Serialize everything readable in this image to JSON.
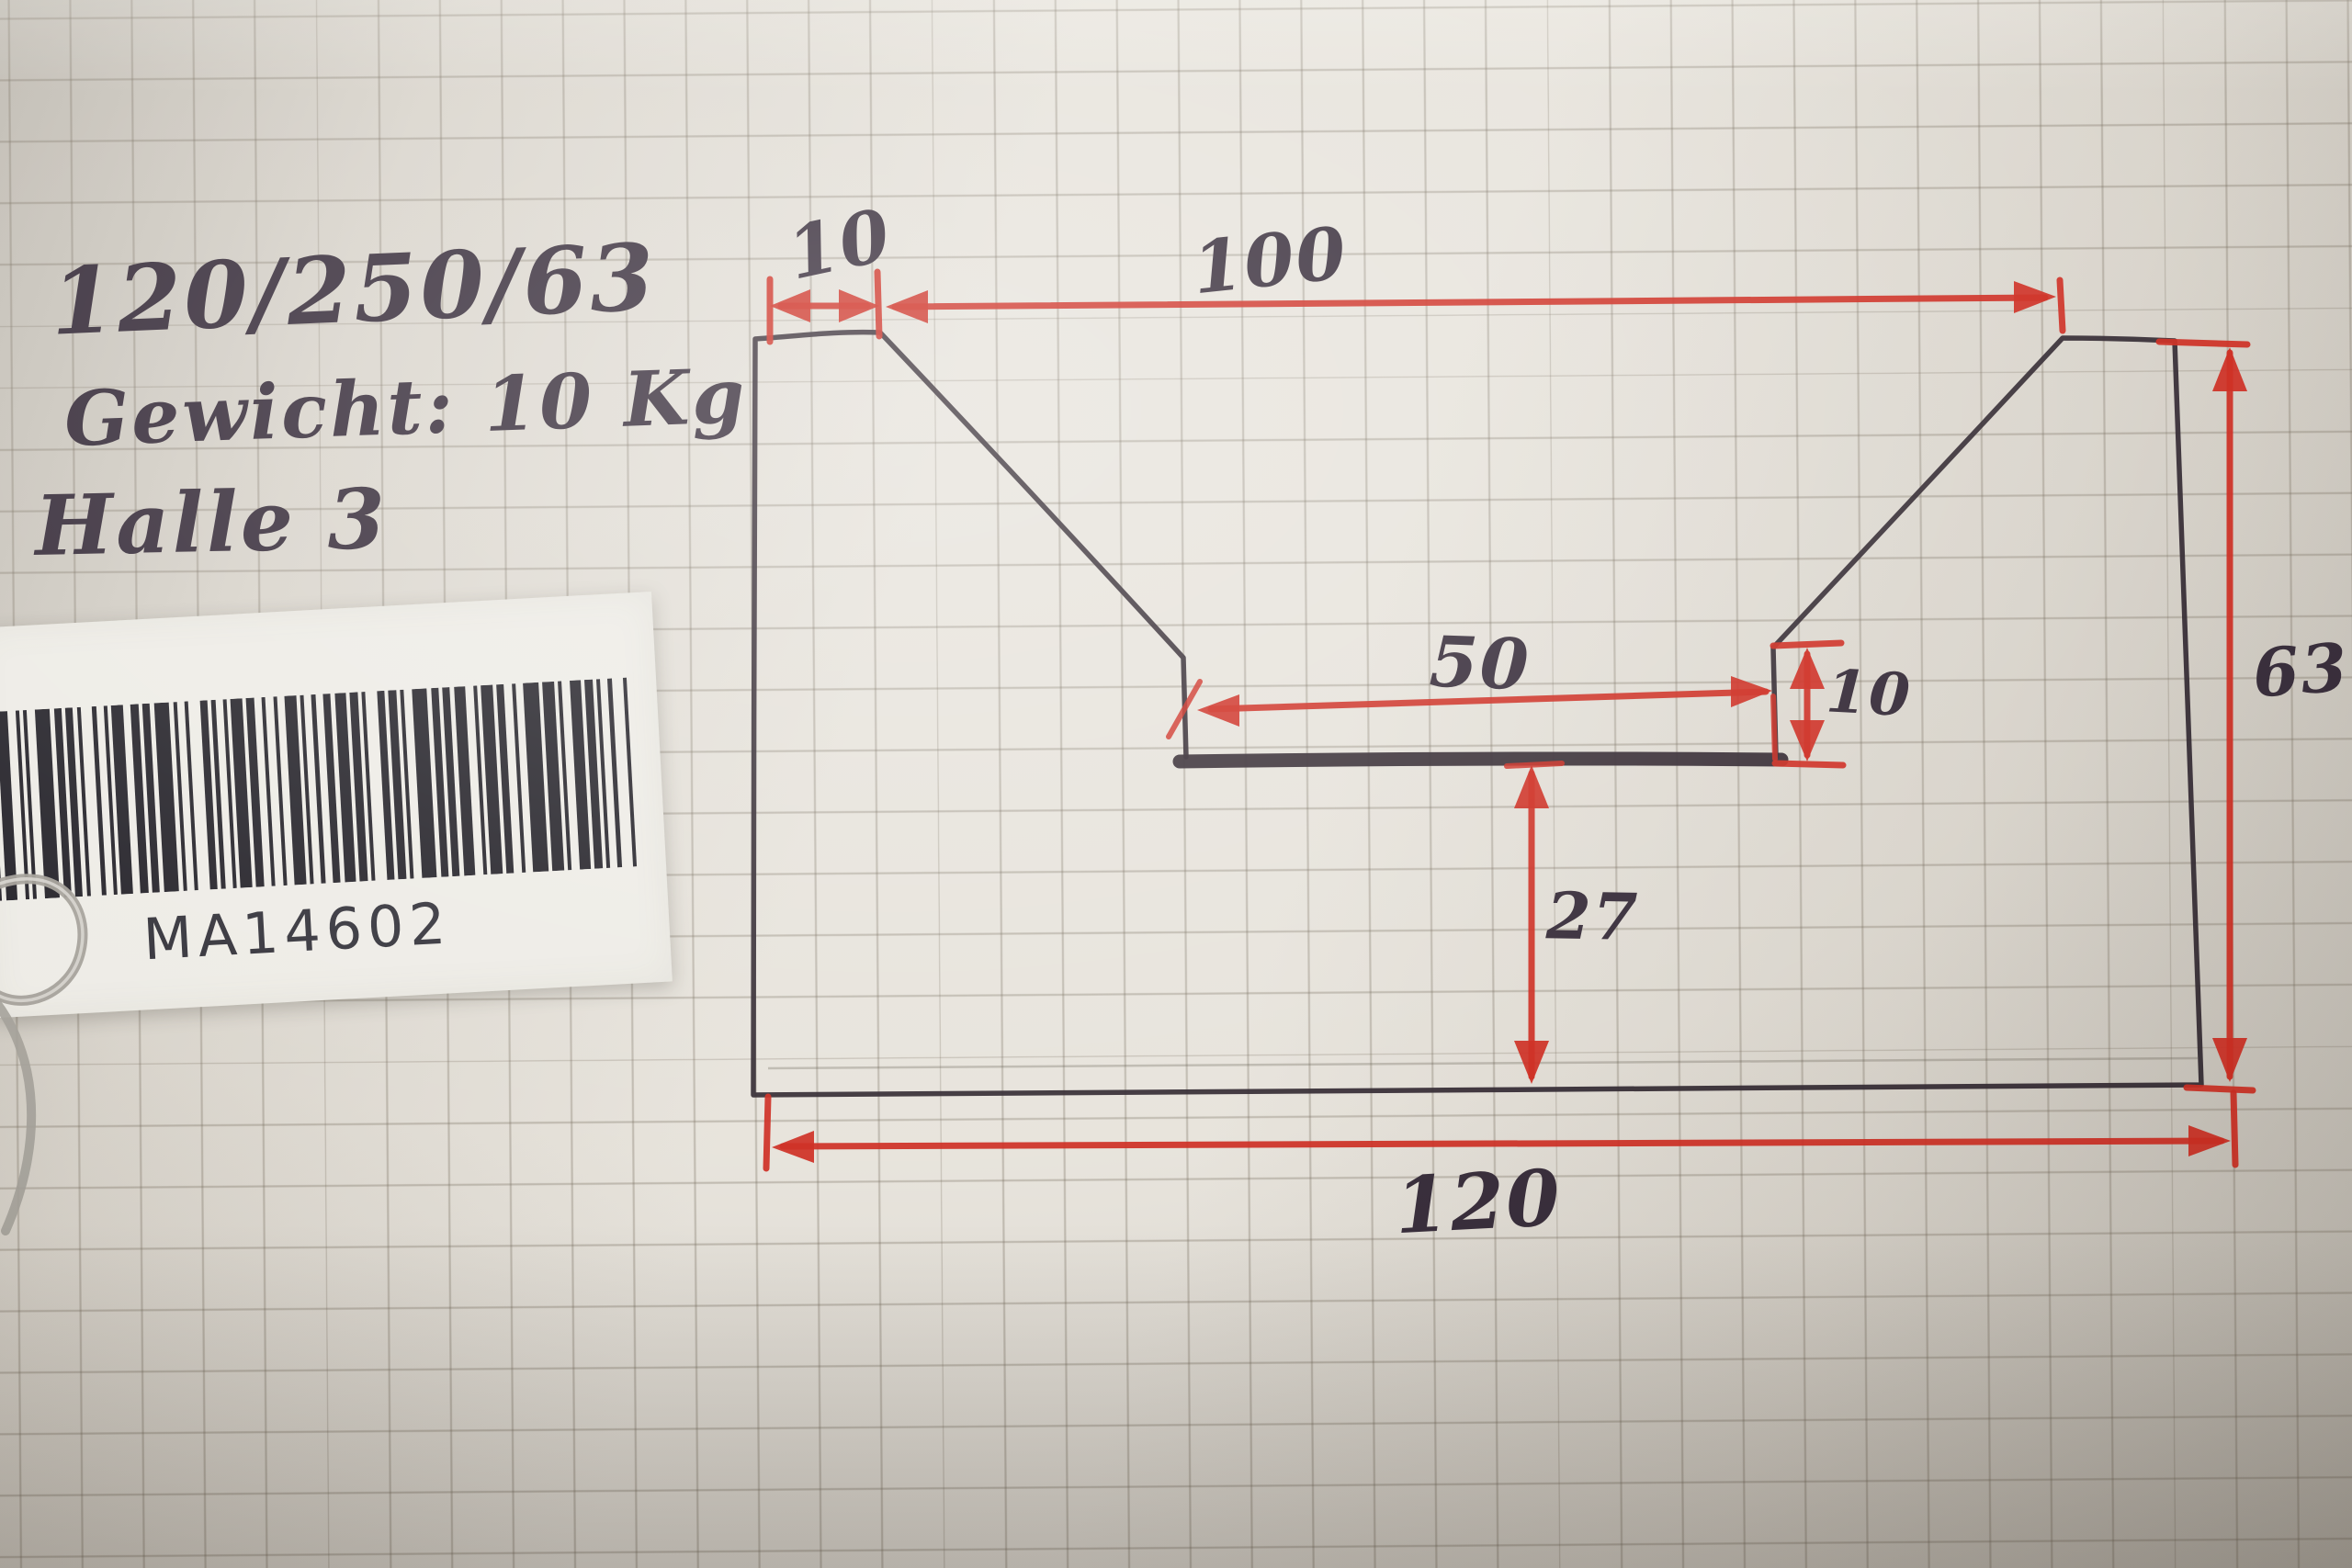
{
  "notes": {
    "line1": "120/250/63",
    "line2": "Gewicht: 10 Kg",
    "line3": "Halle 3"
  },
  "label": {
    "code": "MA14602",
    "barcode_pattern": "213211124121211312113221214112132112113122121231121221312113212112412121321131221241311231211213212131213"
  },
  "drawing": {
    "dims": {
      "corner_flat": "10",
      "top_opening": "100",
      "slot_width": "50",
      "step_height": "10",
      "height": "63",
      "bottom_to_slot": "27",
      "width": "120"
    }
  },
  "colors": {
    "paper_light": "#e6e2da",
    "paper_mid": "#d7d2c9",
    "paper_dark": "#bdb8af",
    "grid_line": "rgba(110,100,84,0.33)",
    "black_ink": "#2b2129",
    "red_ink": "#cb2519",
    "pen_ink": "#2e2331",
    "sticker_white": "#edebe5",
    "barcode_bar": "#1d1b22",
    "label_text": "#2c2b33",
    "clip_gray": "#a19d96"
  }
}
